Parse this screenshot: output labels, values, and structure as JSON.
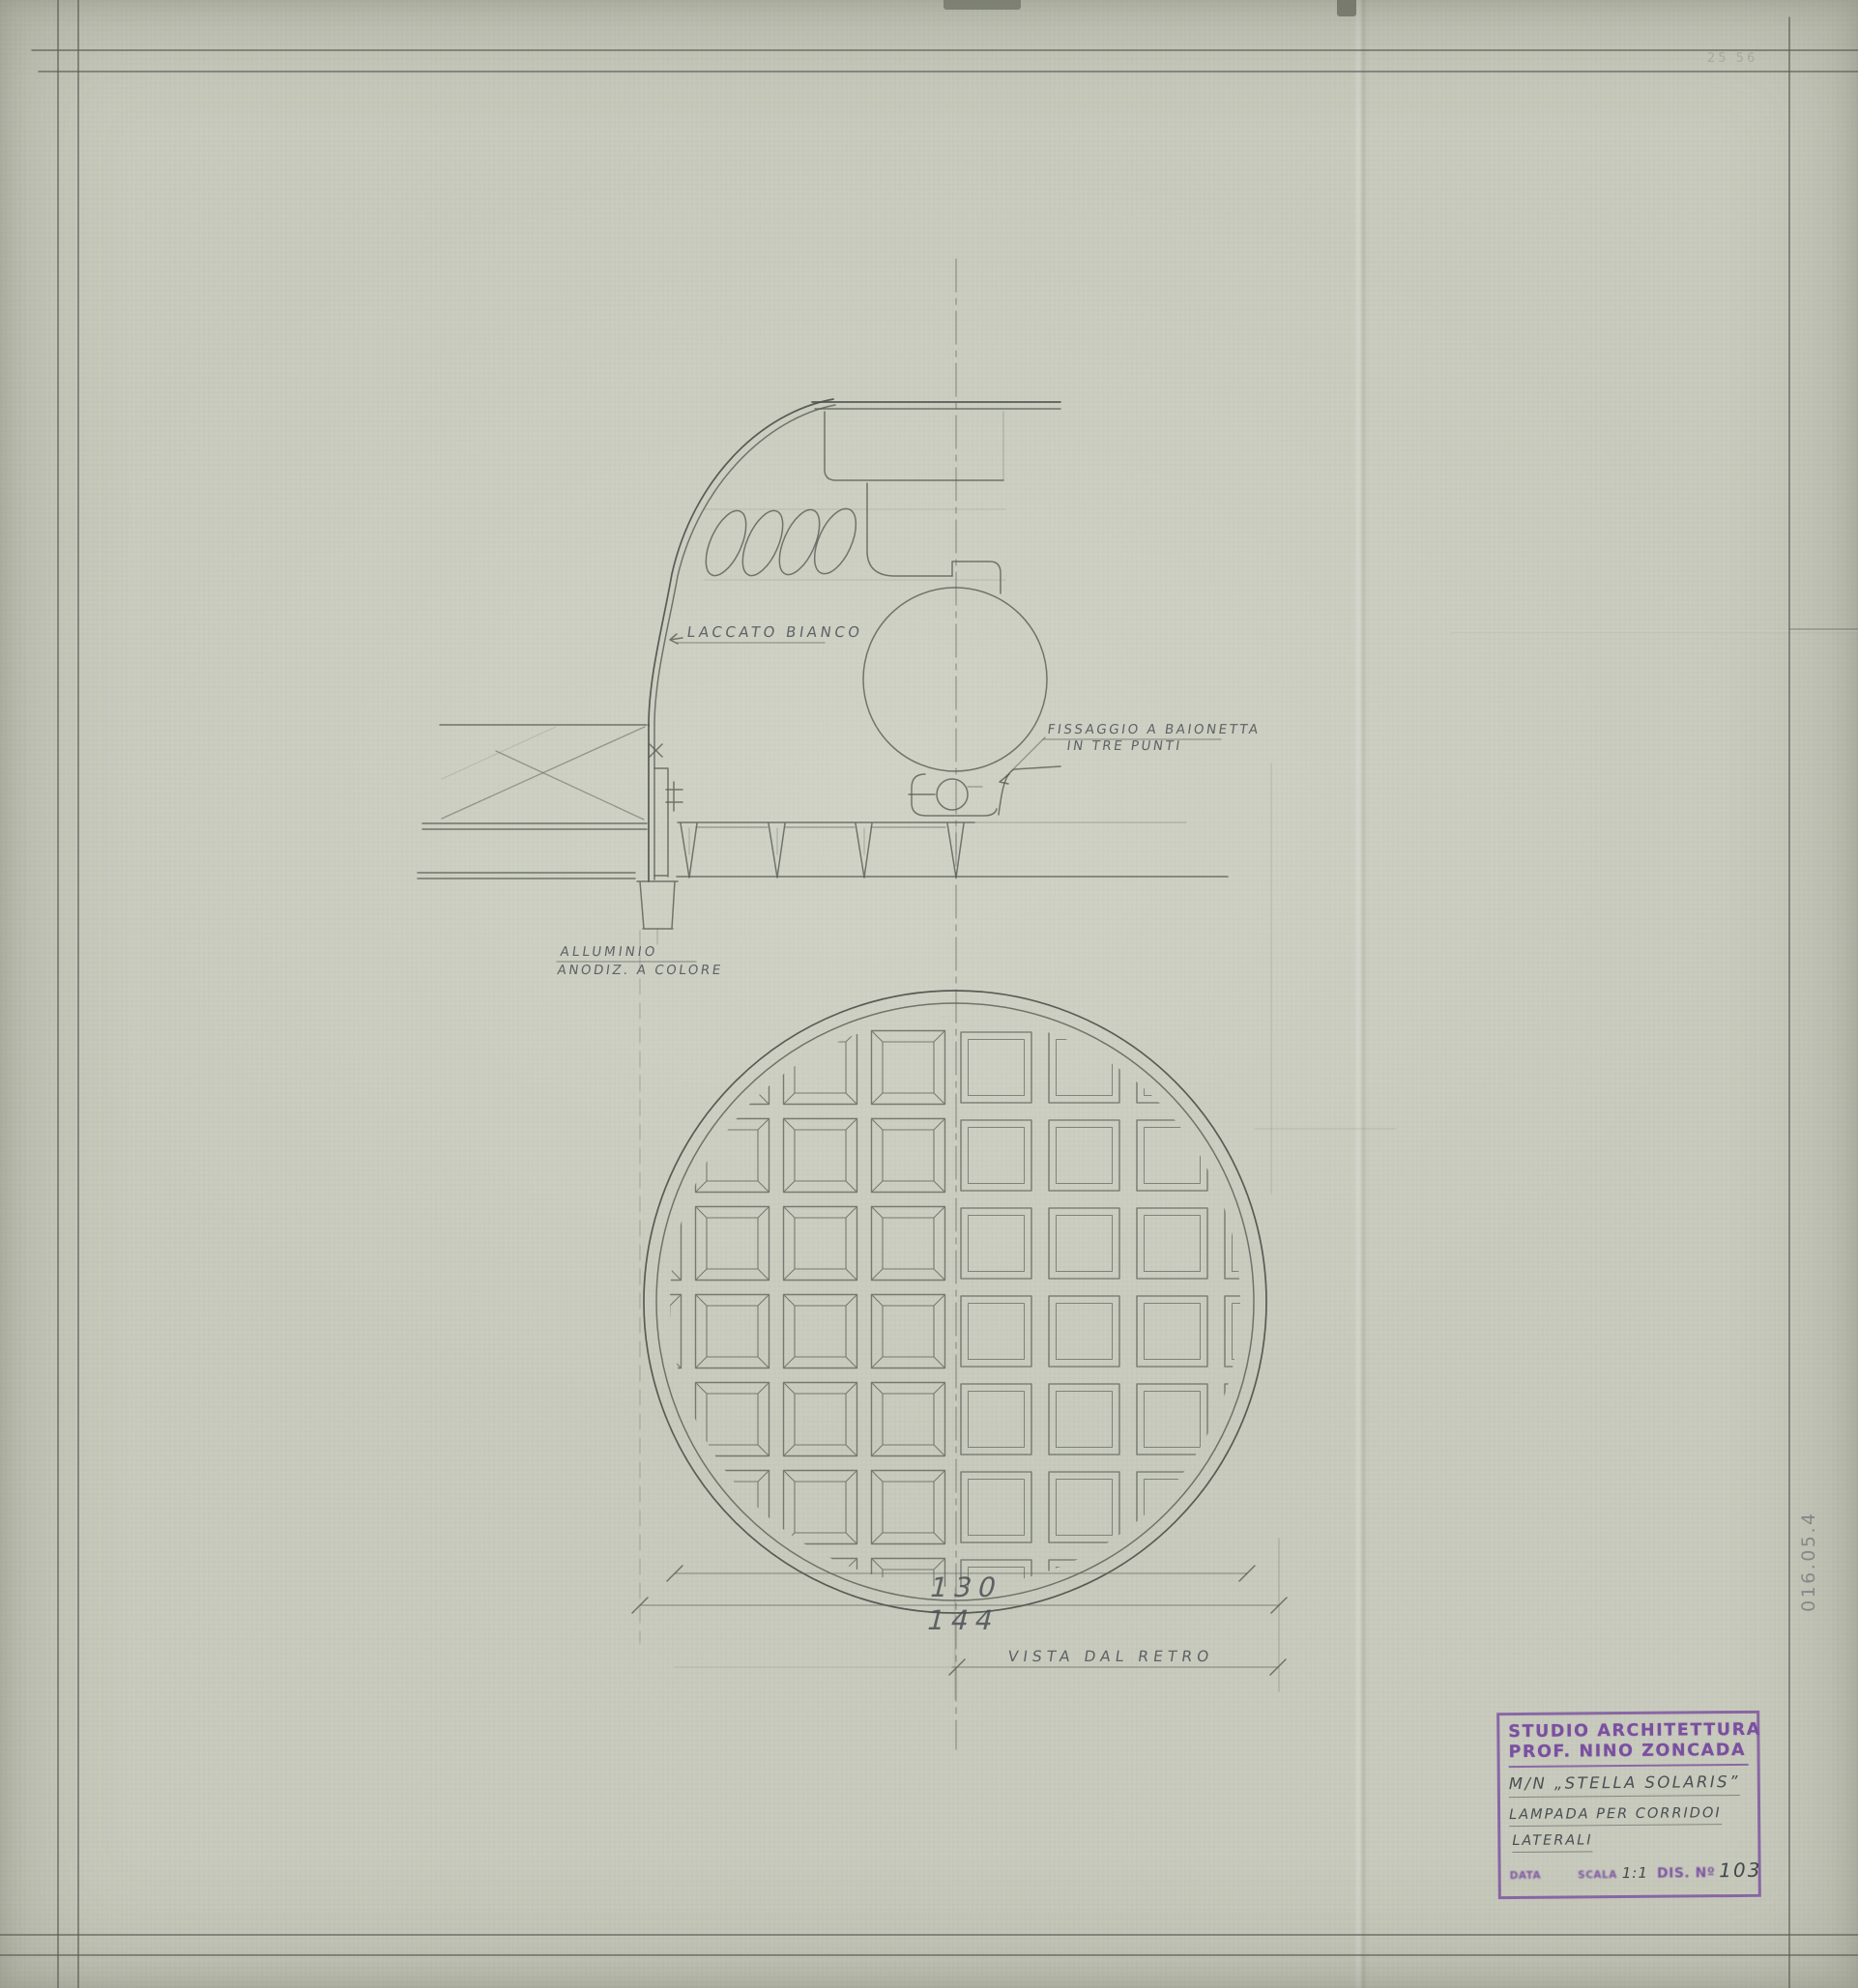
{
  "sheet": {
    "annotations": {
      "laccato": "LACCATO BIANCO",
      "fissaggio_line1": "FISSAGGIO A BAIONETTA",
      "fissaggio_line2": "IN TRE PUNTI",
      "alluminio_line1": "ALLUMINIO",
      "alluminio_line2": "ANODIZ. A COLORE",
      "vista": "VISTA DAL RETRO",
      "faint_top_note": "25 56"
    },
    "dimensions": {
      "inner_diameter": "130",
      "outer_diameter": "144"
    },
    "edge_number": "016.05.4",
    "title_block": {
      "studio_line1": "STUDIO ARCHITETTURA",
      "studio_line2": "PROF. NINO ZONCADA",
      "vessel": "M/N „STELLA SOLARIS”",
      "subject_line1": "LAMPADA PER CORRIDOI",
      "subject_line2": "LATERALI",
      "data_label": "DATA",
      "scala_label": "SCALA",
      "scala_value": "1:1",
      "dis_label": "DIS. Nº",
      "dis_value": "103"
    },
    "colors": {
      "paper": "#c9cbbe",
      "graphite": "#4d524c",
      "stamp_purple": "#7a4fa0"
    }
  }
}
